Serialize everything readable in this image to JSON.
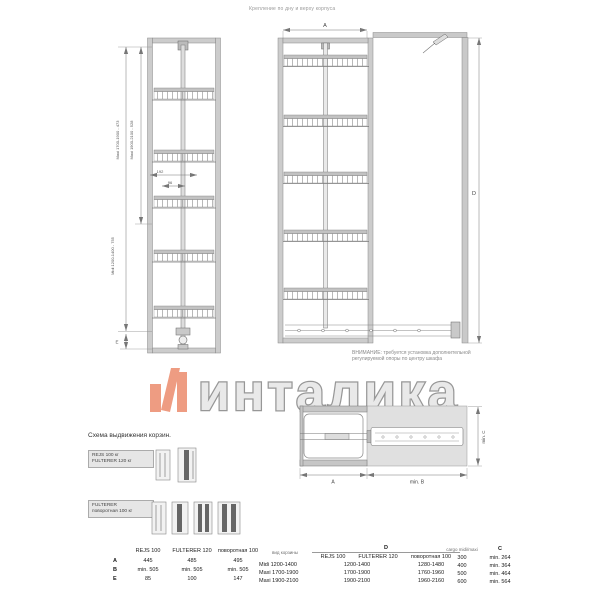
{
  "page": {
    "top_note": "Крепление по дну и верху корпуса"
  },
  "left_drawing": {
    "dim_maxi_1": "Maxi 1700-1900 - 473",
    "dim_maxi_2": "Maxi 1900-2100 - 528",
    "dim_midi": "Midi 1200-1400 - 755",
    "dim_e": "E",
    "dim_192": "192",
    "dim_96": "96"
  },
  "front_drawing": {
    "dim_a": "A",
    "dim_d": "D"
  },
  "warning": {
    "line1": "ВНИМАНИЕ: требуется установка дополнительной",
    "line2": "регулируемой опоры по центру шкафа"
  },
  "plan_drawing": {
    "dim_a": "A",
    "dim_min_b": "min. B",
    "dim_min_c": "min. C"
  },
  "watermark": {
    "wordmark": "инталика",
    "logo_color": "#ee9c82",
    "text_fill": "#e9e9e9",
    "text_stroke": "#979797"
  },
  "scheme": {
    "title": "Схема выдвижения корзин.",
    "label1_line1": "REJS 100 кг",
    "label1_line2": "FULTERER 120 кг",
    "label2_line1": "FULTERER",
    "label2_line2": "поворотная 100 кг"
  },
  "table_dims": {
    "headers": [
      "REJS 100",
      "FULTERER 120",
      "поворотная 100"
    ],
    "rows": [
      {
        "label": "A",
        "values": [
          "445",
          "485",
          "495"
        ]
      },
      {
        "label": "B",
        "values": [
          "min. 505",
          "min. 505",
          "min. 505"
        ]
      },
      {
        "label": "E",
        "values": [
          "85",
          "100",
          "147"
        ]
      }
    ]
  },
  "table_heights": {
    "basket_col": "вид корзины",
    "d_col": "D",
    "sub_headers": [
      "REJS 100",
      "FULTERER 120",
      "поворотная 100"
    ],
    "rows": [
      {
        "basket": "Midi 1200-1400",
        "rejs_fulterer": "1200-1400",
        "rotary": "1280-1480"
      },
      {
        "basket": "Maxi 1700-1900",
        "rejs_fulterer": "1700-1900",
        "rotary": "1760-1960"
      },
      {
        "basket": "Maxi 1900-2100",
        "rejs_fulterer": "1900-2100",
        "rotary": "1960-2160"
      }
    ]
  },
  "table_cargo": {
    "cargo_col": "cargo midi/maxi",
    "c_col": "C",
    "rows": [
      {
        "cargo": "300",
        "c": "min. 264"
      },
      {
        "cargo": "400",
        "c": "min. 364"
      },
      {
        "cargo": "500",
        "c": "min. 464"
      },
      {
        "cargo": "600",
        "c": "min. 564"
      }
    ]
  }
}
